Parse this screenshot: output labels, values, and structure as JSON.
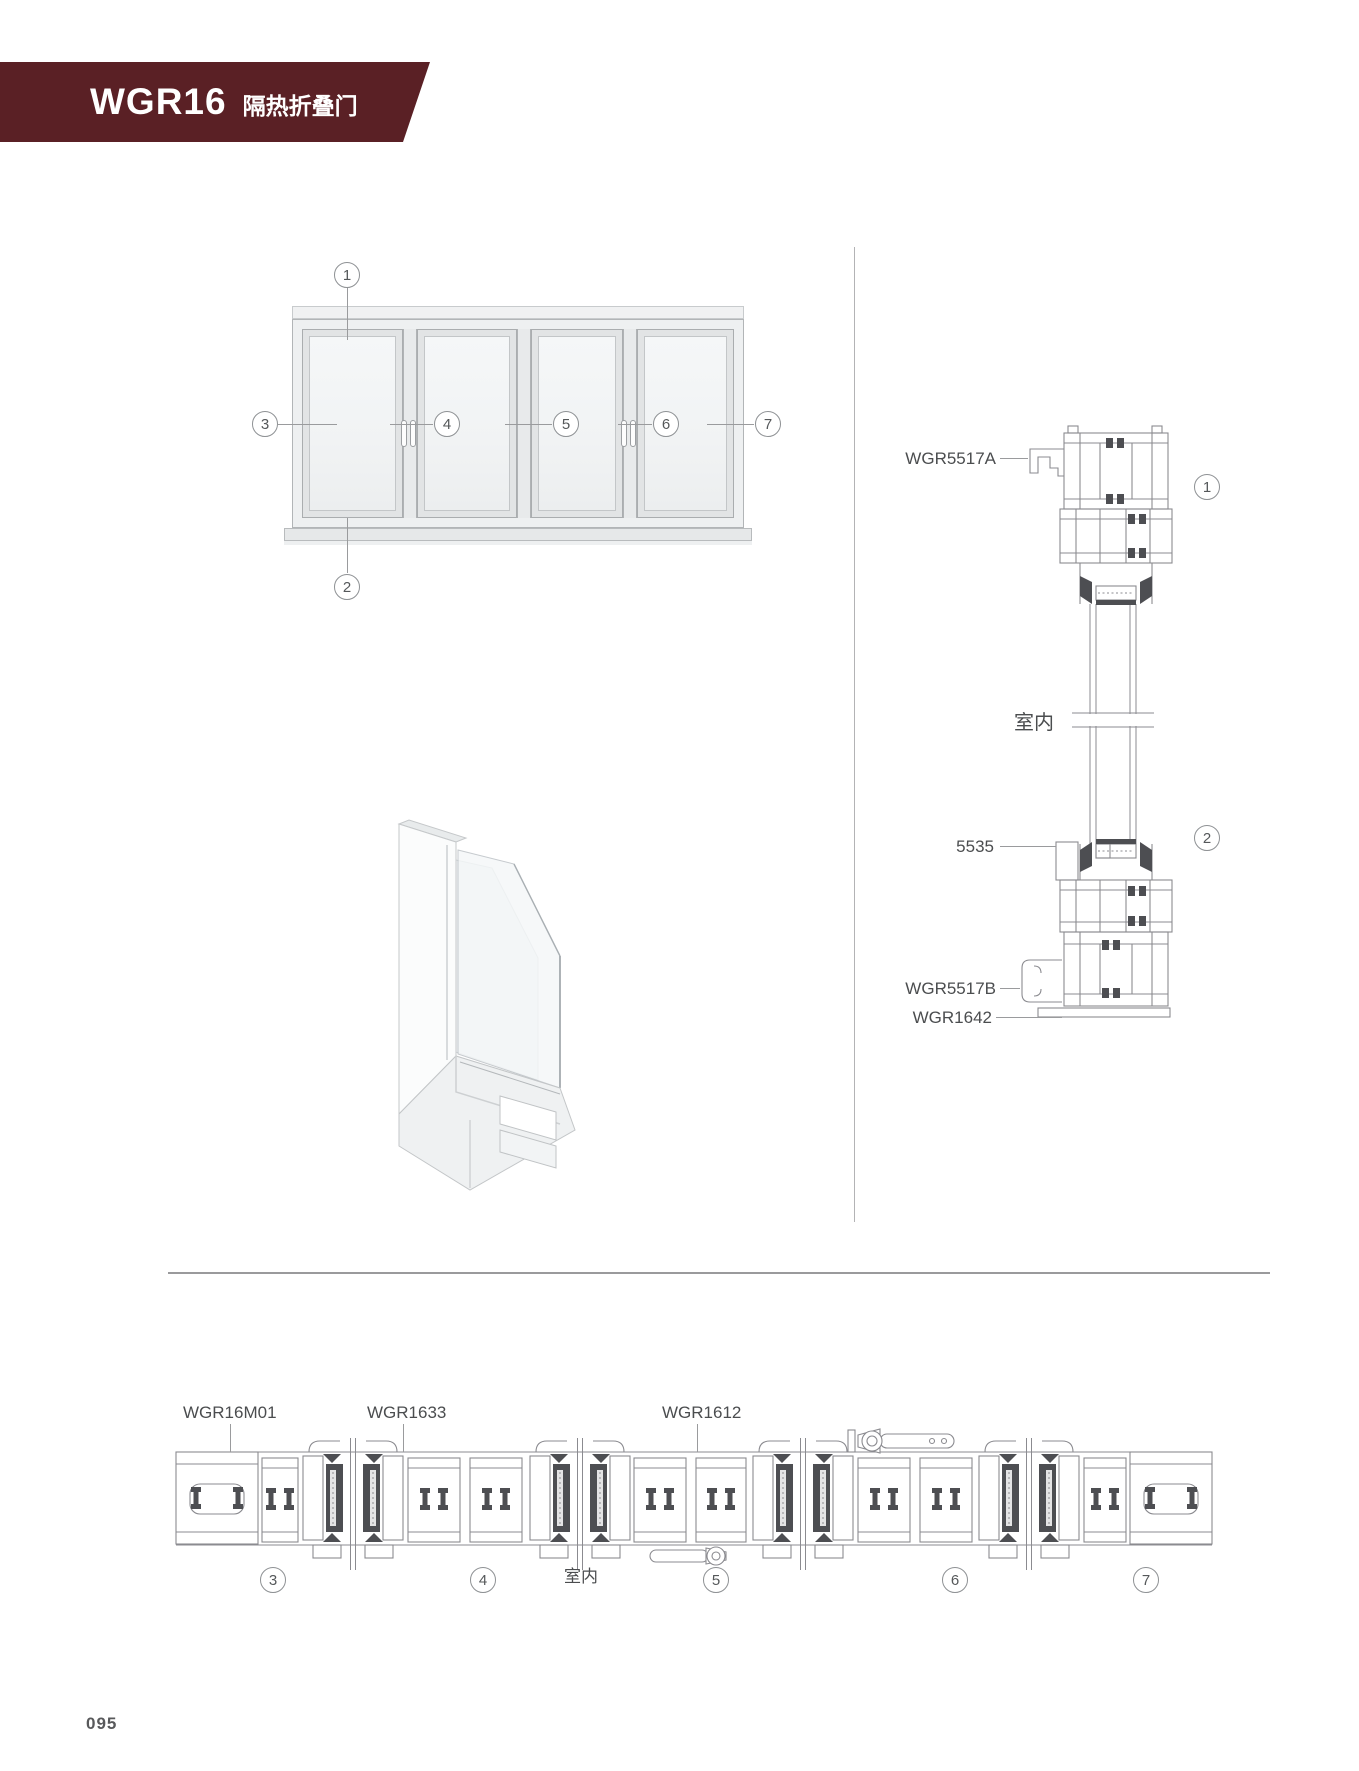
{
  "header": {
    "model": "WGR16",
    "title": "隔热折叠门",
    "banner_color": "#5a2025"
  },
  "elevation": {
    "description": "folding-door-elevation-4-panels",
    "callouts": [
      "1",
      "2",
      "3",
      "4",
      "5",
      "6",
      "7"
    ]
  },
  "vertical_section": {
    "labels": {
      "top_trim": "WGR5517A",
      "indoor": "室内",
      "bead": "5535",
      "bottom_trim": "WGR5517B",
      "bottom_rail": "WGR1642"
    },
    "callouts": [
      "1",
      "2"
    ]
  },
  "horizontal_section": {
    "labels": {
      "jamb": "WGR16M01",
      "sash": "WGR1633",
      "interlock": "WGR1612",
      "indoor": "室内"
    },
    "callouts": [
      "3",
      "4",
      "5",
      "6",
      "7"
    ]
  },
  "footer": {
    "page_number": "095"
  },
  "colors": {
    "banner": "#5a2025",
    "drawing_line": "#8b8b90",
    "drawing_dark_fill": "#4d4e52"
  }
}
